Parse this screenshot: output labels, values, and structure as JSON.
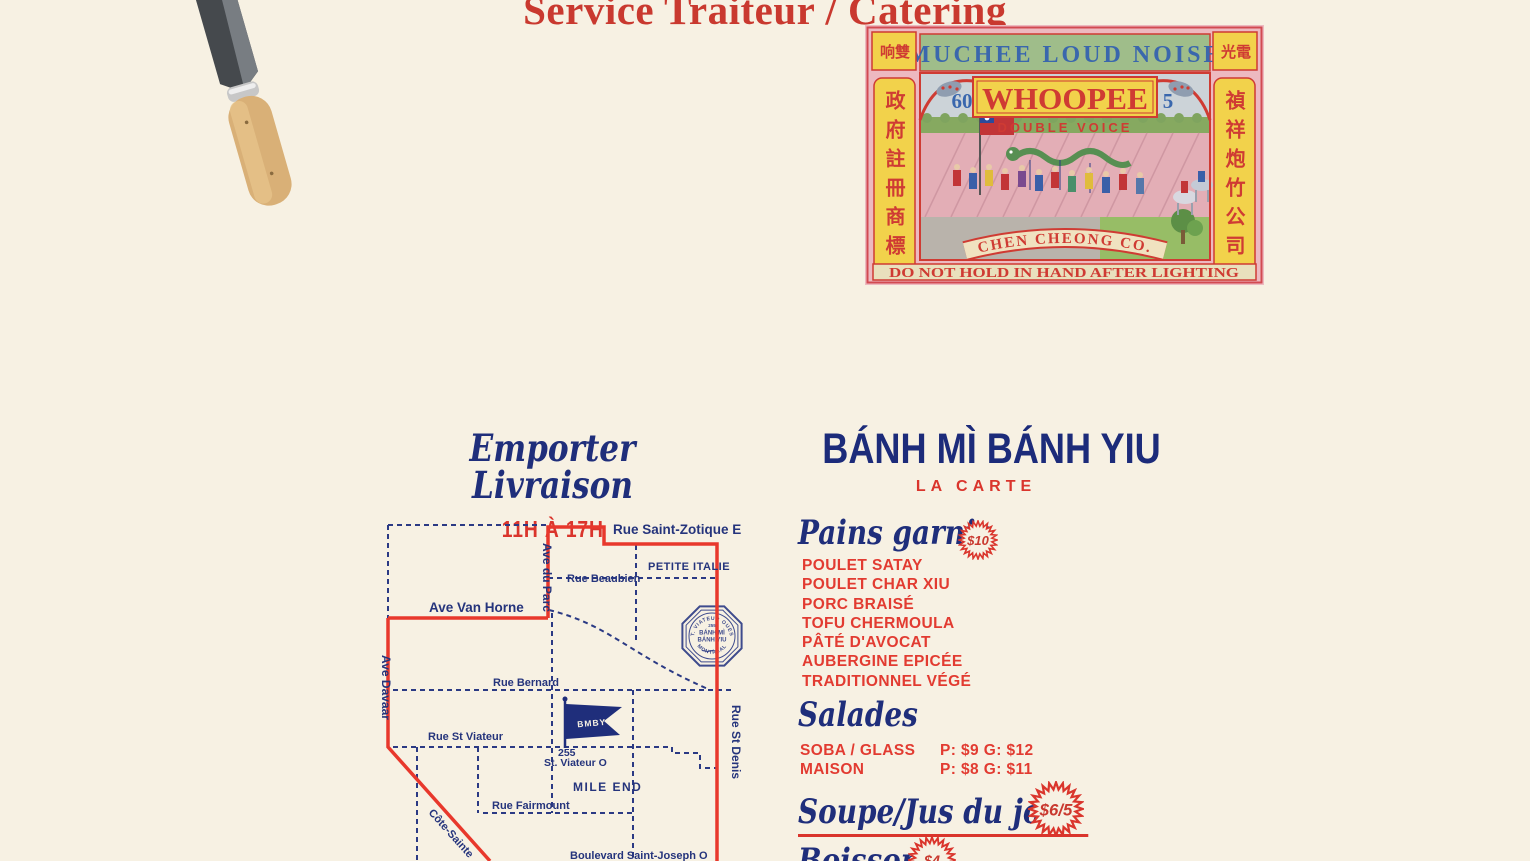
{
  "header": {
    "title": "Service Traiteur / Catering"
  },
  "firecracker_label": {
    "corner_top_left": "响雙",
    "corner_top_right": "光電",
    "brand_line": "MUCHEE LOUD NOISE",
    "product_name": "WHOOPEE",
    "subtitle": "DOUBLE VOICE",
    "number_left": "60",
    "number_right": "5",
    "left_column": "政府註冊商標",
    "right_column": "禎祥炮竹公司",
    "company": "CHEN CHEONG CO.",
    "warning": "DO NOT HOLD IN HAND AFTER LIGHTING"
  },
  "takeout": {
    "title": "Emporter Livraison",
    "hours": "11H À 17H"
  },
  "map": {
    "streets": {
      "rue_saint_zotique": "Rue Saint-Zotique E",
      "petite_italie": "PETITE ITALIE",
      "rue_beaubien": "Rue Beaubien",
      "ave_du_parc": "Ave du Parc",
      "ave_van_horne": "Ave Van Horne",
      "ave_davaar": "Ave Davaar",
      "rue_bernard": "Rue Bernard",
      "rue_st_viateur": "Rue St Viateur",
      "address_number": "255",
      "address_street": "St. Viateur O",
      "mile_end": "MILE END",
      "rue_fairmount": "Rue Fairmount",
      "cote_sainte": "Côte-Sainte",
      "boulevard_saint_joseph": "Boulevard Saint-Joseph O",
      "rue_st_denis": "Rue St Denis"
    },
    "flag_label": "BMBY",
    "stamp": {
      "arc_top": "ST. VIATEUR OUEST",
      "number": "255",
      "name_line1": "BÁNH MÌ",
      "name_line2": "BÁNH YIU",
      "arc_bottom": "MONTRÉAL"
    }
  },
  "menu": {
    "title": "BÁNH MÌ BÁNH YIU",
    "subtitle": "LA CARTE",
    "sections": {
      "pains_garnis": {
        "title": "Pains garnis",
        "price_badge": "$10",
        "items": [
          "POULET SATAY",
          "POULET CHAR XIU",
          "PORC BRAISÉ",
          "TOFU CHERMOULA",
          "PÂTÉ D'AVOCAT",
          "AUBERGINE EPICÉE",
          "TRADITIONNEL VÉGÉ"
        ]
      },
      "salades": {
        "title": "Salades",
        "items": [
          {
            "name": "SOBA / GLASS",
            "price": "P: $9 G: $12"
          },
          {
            "name": "MAISON",
            "price": "P: $8 G: $11"
          }
        ]
      },
      "soupe": {
        "title": "Soupe/Jus du jour",
        "price_badge": "$6/5"
      },
      "boissons": {
        "title": "Boissons",
        "price_badge": "$4"
      }
    }
  },
  "colors": {
    "background": "#f7f1e3",
    "navy": "#1f2e7b",
    "red": "#da352c",
    "map_red": "#e8382c",
    "label_red": "#cf3b33",
    "label_yellow": "#f2d24b",
    "label_green_band": "#9fbd8a",
    "label_pink": "#edb9c0"
  }
}
